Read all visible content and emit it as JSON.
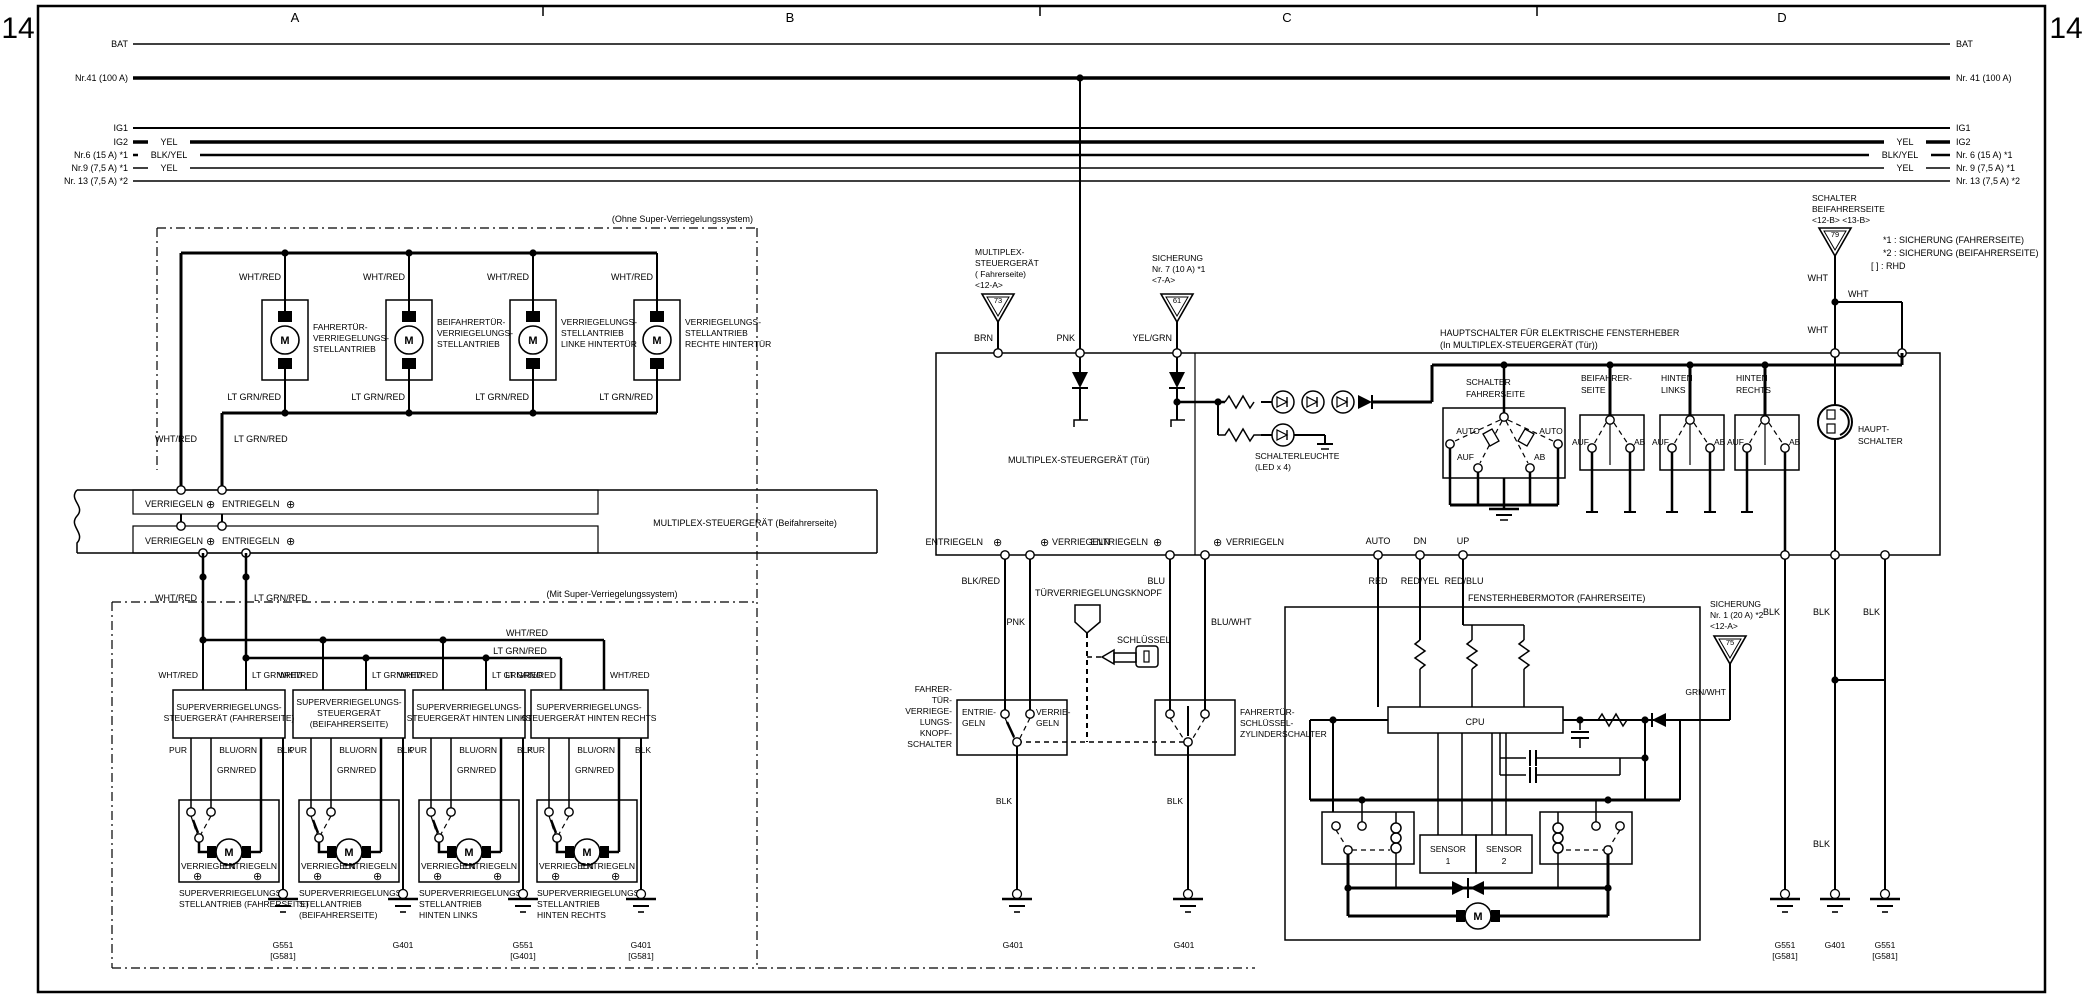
{
  "colors": {
    "ink": "#000000",
    "paper": "#ffffff"
  },
  "page": {
    "sheet_number": "14"
  },
  "columns": {
    "a": "A",
    "b": "B",
    "c": "C",
    "d": "D"
  },
  "buses": {
    "bat": "BAT",
    "nr41": "Nr.41 (100 A)",
    "nr41_r": "Nr. 41 (100 A)",
    "ig1": "IG1",
    "ig2": "IG2",
    "nr6": "Nr.6 (15 A) *1",
    "nr6_r": "Nr. 6 (15 A) *1",
    "nr9": "Nr.9 (7,5 A) *1",
    "nr9_r": "Nr. 9 (7,5 A) *1",
    "nr13": "Nr. 13 (7,5 A) *2",
    "nr13_r": "Nr. 13 (7,5 A) *2"
  },
  "wires": {
    "yel": "YEL",
    "blkyel": "BLK/YEL",
    "whtred": "WHT/RED",
    "ltgrnred": "LT GRN/RED",
    "pur": "PUR",
    "grnred": "GRN/RED",
    "bluorn": "BLU/ORN",
    "blk": "BLK",
    "brn": "BRN",
    "pnk": "PNK",
    "yelgrn": "YEL/GRN",
    "blkred": "BLK/RED",
    "blu": "BLU",
    "bluwht": "BLU/WHT",
    "red": "RED",
    "redyel": "RED/YEL",
    "redblu": "RED/BLU",
    "grnwht": "GRN/WHT",
    "wht": "WHT"
  },
  "sections": {
    "ohne": "(Ohne Super-Verriegelungssystem)",
    "mit": "(Mit Super-Verriegelungssystem)"
  },
  "motor_m": "M",
  "lock_actuators": [
    {
      "lines": [
        "FAHRERTÜR-",
        "VERRIEGELUNGS-",
        "STELLANTRIEB"
      ]
    },
    {
      "lines": [
        "BEIFAHRERTÜR-",
        "VERRIEGELUNGS-",
        "STELLANTRIEB"
      ]
    },
    {
      "lines": [
        "VERRIEGELUNGS-",
        "STELLANTRIEB",
        "LINKE HINTERTÜR"
      ]
    },
    {
      "lines": [
        "VERRIEGELUNGS-",
        "STELLANTRIEB",
        "RECHTE HINTERTÜR"
      ]
    }
  ],
  "multiplex_beifahrer": {
    "title": "MULTIPLEX-STEUERGERÄT (Beifahrerseite)",
    "verriegeln": "VERRIEGELN",
    "entriegeln": "ENTRIEGELN",
    "plus": "⊕"
  },
  "super_units": [
    {
      "lines": [
        "SUPERVERRIEGELUNGS-",
        "STEUERGERÄT (FAHRERSEITE)",
        ""
      ]
    },
    {
      "lines": [
        "SUPERVERRIEGELUNGS-",
        "STEUERGERÄT",
        "(BEIFAHRERSEITE)"
      ]
    },
    {
      "lines": [
        "SUPERVERRIEGELUNGS-",
        "STEUERGERÄT HINTEN LINKS",
        ""
      ]
    },
    {
      "lines": [
        "SUPERVERRIEGELUNGS-",
        "STEUERGERÄT HINTEN RECHTS",
        ""
      ]
    }
  ],
  "super_actuators": [
    {
      "lines": [
        "SUPERVERRIEGELUNGS-",
        "STELLANTRIEB (FAHRERSEITE)",
        ""
      ],
      "ground1": "G551",
      "ground2": "[G581]"
    },
    {
      "lines": [
        "SUPERVERRIEGELUNGS-",
        "STELLANTRIEB",
        "(BEIFAHRERSEITE)"
      ],
      "ground1": "G401",
      "ground2": ""
    },
    {
      "lines": [
        "SUPERVERRIEGELUNGS-",
        "STELLANTRIEB",
        "HINTEN LINKS"
      ],
      "ground1": "G551",
      "ground2": "[G401]"
    },
    {
      "lines": [
        "SUPERVERRIEGELUNGS-",
        "STELLANTRIEB",
        "HINTEN RECHTS"
      ],
      "ground1": "G401",
      "ground2": "[G581]"
    }
  ],
  "mux_fahrer": {
    "l1": "MULTIPLEX-",
    "l2": "STEUERGERÄT",
    "l3": "( Fahrerseite)",
    "l4": "<12-A>",
    "conn": "73"
  },
  "sicherung7": {
    "l1": "SICHERUNG",
    "l2": "Nr. 7 (10 A) *1",
    "l3": "<7-A>",
    "conn": "61"
  },
  "mux_tuer": "MULTIPLEX-STEUERGERÄT (Tür)",
  "schalterleuchte": {
    "l1": "SCHALTERLEUCHTE",
    "l2": "(LED x 4)"
  },
  "hauptschalter_header": {
    "l1": "HAUPTSCHALTER FÜR ELEKTRISCHE FENSTERHEBER",
    "l2": "(In MULTIPLEX-STEUERGERÄT (Tür))"
  },
  "fahrer_switch": {
    "t1": "SCHALTER",
    "t2": "FAHRERSEITE",
    "auto": "AUTO",
    "auf": "AUF",
    "ab": "AB"
  },
  "passenger_switches": [
    {
      "t1": "BEIFAHRER-",
      "t2": "SEITE",
      "auf": "AUF",
      "ab": "AB"
    },
    {
      "t1": "HINTEN",
      "t2": "LINKS",
      "auf": "AUF",
      "ab": "AB"
    },
    {
      "t1": "HINTEN",
      "t2": "RECHTS",
      "auf": "AUF",
      "ab": "AB"
    }
  ],
  "haupt_schalter": {
    "l1": "HAUPT-",
    "l2": "SCHALTER"
  },
  "terminals": {
    "entriegeln": "ENTRIEGELN",
    "verriegeln": "VERRIEGELN",
    "plus": "⊕",
    "auto": "AUTO",
    "dn": "DN",
    "up": "UP"
  },
  "tuerknopf": "TÜRVERRIEGELUNGSKNOPF",
  "schluessel": "SCHLÜSSEL",
  "knopfschalter": {
    "l1": "FAHRER-",
    "l2": "TÜR-",
    "l3": "VERRIEGE-",
    "l4": "LUNGS-",
    "l5": "KNOPF-",
    "l6": "SCHALTER",
    "e1": "ENTRIE-",
    "e2": "GELN",
    "v1": "VERRIE-",
    "v2": "GELN",
    "ground": "G401"
  },
  "zylinderschalter": {
    "l1": "FAHRERTÜR-",
    "l2": "SCHLÜSSEL-",
    "l3": "ZYLINDERSCHALTER",
    "ground": "G401"
  },
  "fenstermotor": {
    "title": "FENSTERHEBERMOTOR (FAHRERSEITE)",
    "cpu": "CPU",
    "s1a": "SENSOR",
    "s1b": "1",
    "s2a": "SENSOR",
    "s2b": "2"
  },
  "sicherung1": {
    "l1": "SICHERUNG",
    "l2": "Nr. 1 (20 A) *2",
    "l3": "<12-A>",
    "conn": "75"
  },
  "schalter_beifahrer": {
    "l1": "SCHALTER",
    "l2": "BEIFAHRERSEITE",
    "l3": "<12-B> <13-B>",
    "conn": "79"
  },
  "notes": {
    "n1": "*1 : SICHERUNG (FAHRERSEITE)",
    "n2": "*2 : SICHERUNG (BEIFAHRERSEITE)",
    "n3": "[   ] : RHD"
  },
  "grounds_right": [
    {
      "g1": "G551",
      "g2": "[G581]"
    },
    {
      "g1": "G401",
      "g2": ""
    },
    {
      "g1": "G551",
      "g2": "[G581]"
    }
  ]
}
